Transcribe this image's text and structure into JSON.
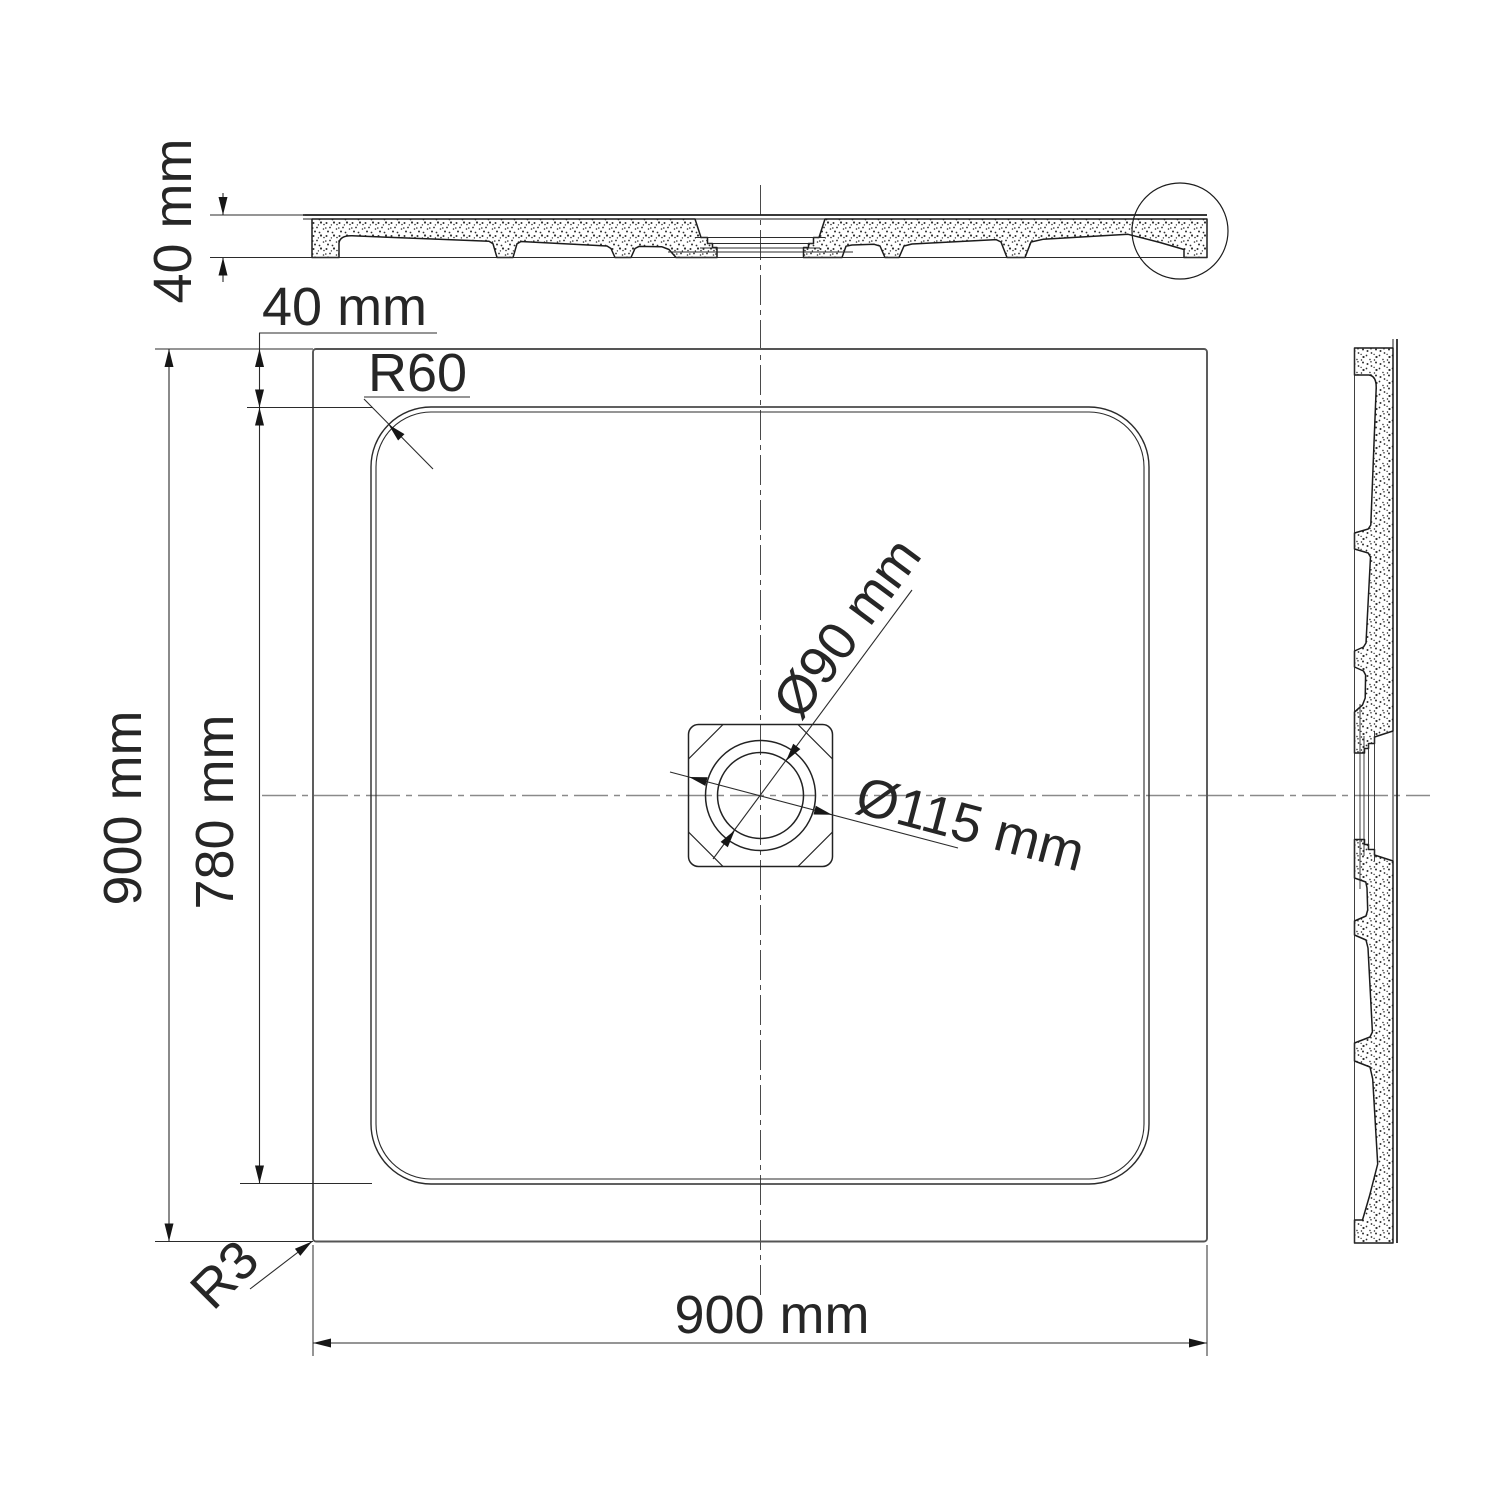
{
  "drawing": {
    "type": "technical-drawing",
    "views": {
      "top_section": "horizontal cross-section of shower tray",
      "plan": "plan view of square shower tray with center drain",
      "side_section": "vertical cross-section of shower tray"
    },
    "dimensions": {
      "section_height": "40 mm",
      "rim_inset": "40 mm",
      "inner_corner_radius": "R60",
      "overall_height_left": "900 mm",
      "inner_height": "780 mm",
      "drain_diameter": "Ø90 mm",
      "drain_flange_diameter": "Ø115 mm",
      "outer_corner_radius": "R3",
      "overall_width_bottom": "900 mm"
    },
    "colors": {
      "line": "#1c1c1c",
      "dimension": "#262626",
      "centerline_vertical": "#4a4a4a",
      "centerline_horizontal": "#8a8a8a",
      "background": "#ffffff"
    }
  }
}
